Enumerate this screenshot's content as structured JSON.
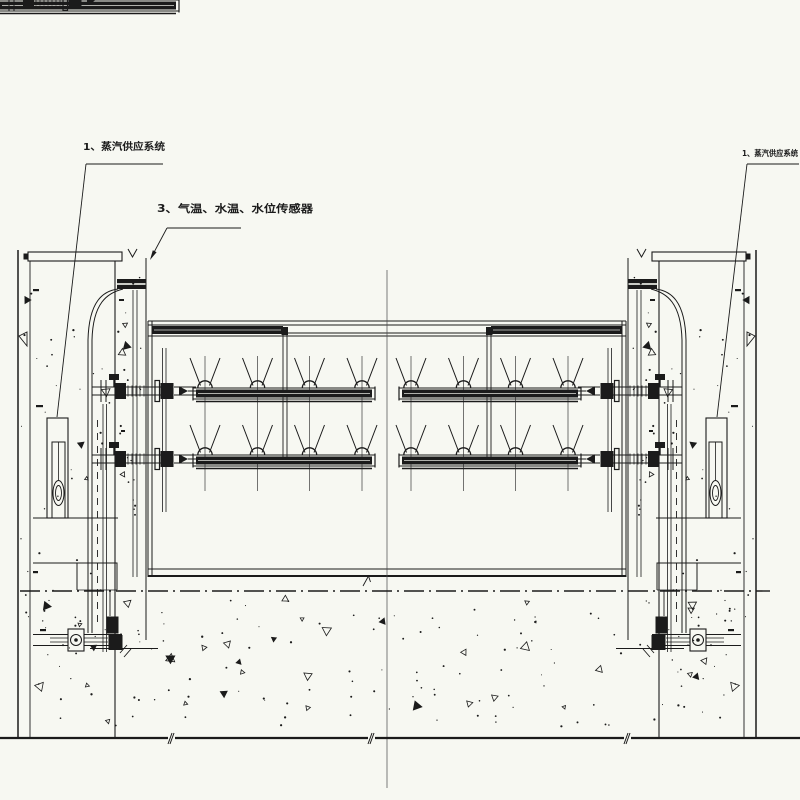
{
  "drawing": {
    "background_color": "#f7f8f2",
    "line_color": "#1b1b1b",
    "centerline_color": "#4a4a4a",
    "labels": {
      "steam_left": "1、蒸汽供应系统",
      "sensors": "3、气温、水温、水位传感器",
      "steam_right": "1、蒸汽供应系统"
    }
  }
}
